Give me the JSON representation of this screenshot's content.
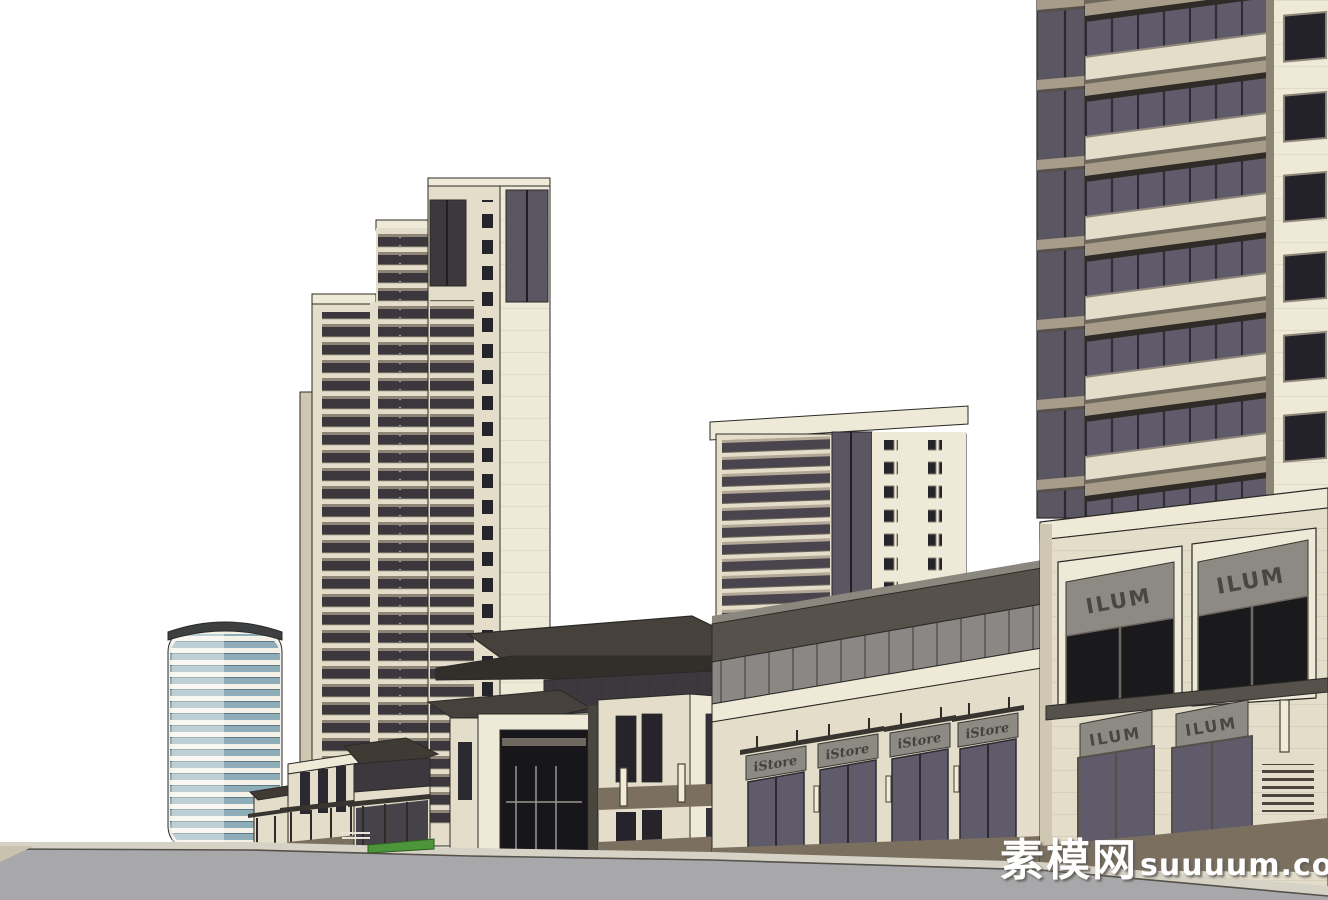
{
  "scene": {
    "description": "SketchUp-style architectural massing render: residential high-rise complex with ground-floor retail podium, entrance gate pavilion and street in foreground",
    "buildings": [
      {
        "name": "round-glass-tower",
        "position": "far-left",
        "floors_visible": 19
      },
      {
        "name": "twin-residential-towers",
        "position": "center-left",
        "floors_visible": 22
      },
      {
        "name": "mid-rise-residential-tower",
        "position": "center-right",
        "floors_visible": 13
      },
      {
        "name": "foreground-balcony-tower",
        "position": "right",
        "floors_visible": 7
      },
      {
        "name": "entrance-gate-pavilion",
        "position": "center-foreground"
      },
      {
        "name": "istore-retail-strip",
        "storefronts": 4
      },
      {
        "name": "ilum-retail-podium",
        "storefronts": 4
      }
    ]
  },
  "signs": {
    "istore_labels": [
      "iStore",
      "iStore",
      "iStore",
      "iStore"
    ],
    "ilum_upper": [
      "ILUM",
      "ILUM"
    ],
    "ilum_lower": [
      "ILUM",
      "ILUM"
    ]
  },
  "watermark": {
    "cn": "素模网",
    "en": "suuuum.com"
  },
  "colors": {
    "white": "#ffffff",
    "cream": "#e4ddca",
    "cream-light": "#efe9d8",
    "cream-shade": "#cfc7b2",
    "cream-dark": "#b9b19c",
    "roof-dark": "#3f3a34",
    "roof-fascia": "#56514a",
    "glass-dark": "#3c383e",
    "glass-slate": "#5a5662",
    "glass-purple": "#605b6a",
    "glass-clerestory": "#8b8785",
    "glass-teal": "#8fadb8",
    "tan-slab": "#a79c88",
    "base-brown": "#7b7060",
    "sign-gray": "#8d8a83",
    "sign-text": "#45423c",
    "road": "#a8a8aa",
    "sidewalk": "#d6d2c6",
    "curb": "#c9c2ae",
    "hedge": "#4c953b",
    "line": "#2b2a27",
    "lamp": "#f2ecd6",
    "win-dark": "#26242b"
  }
}
